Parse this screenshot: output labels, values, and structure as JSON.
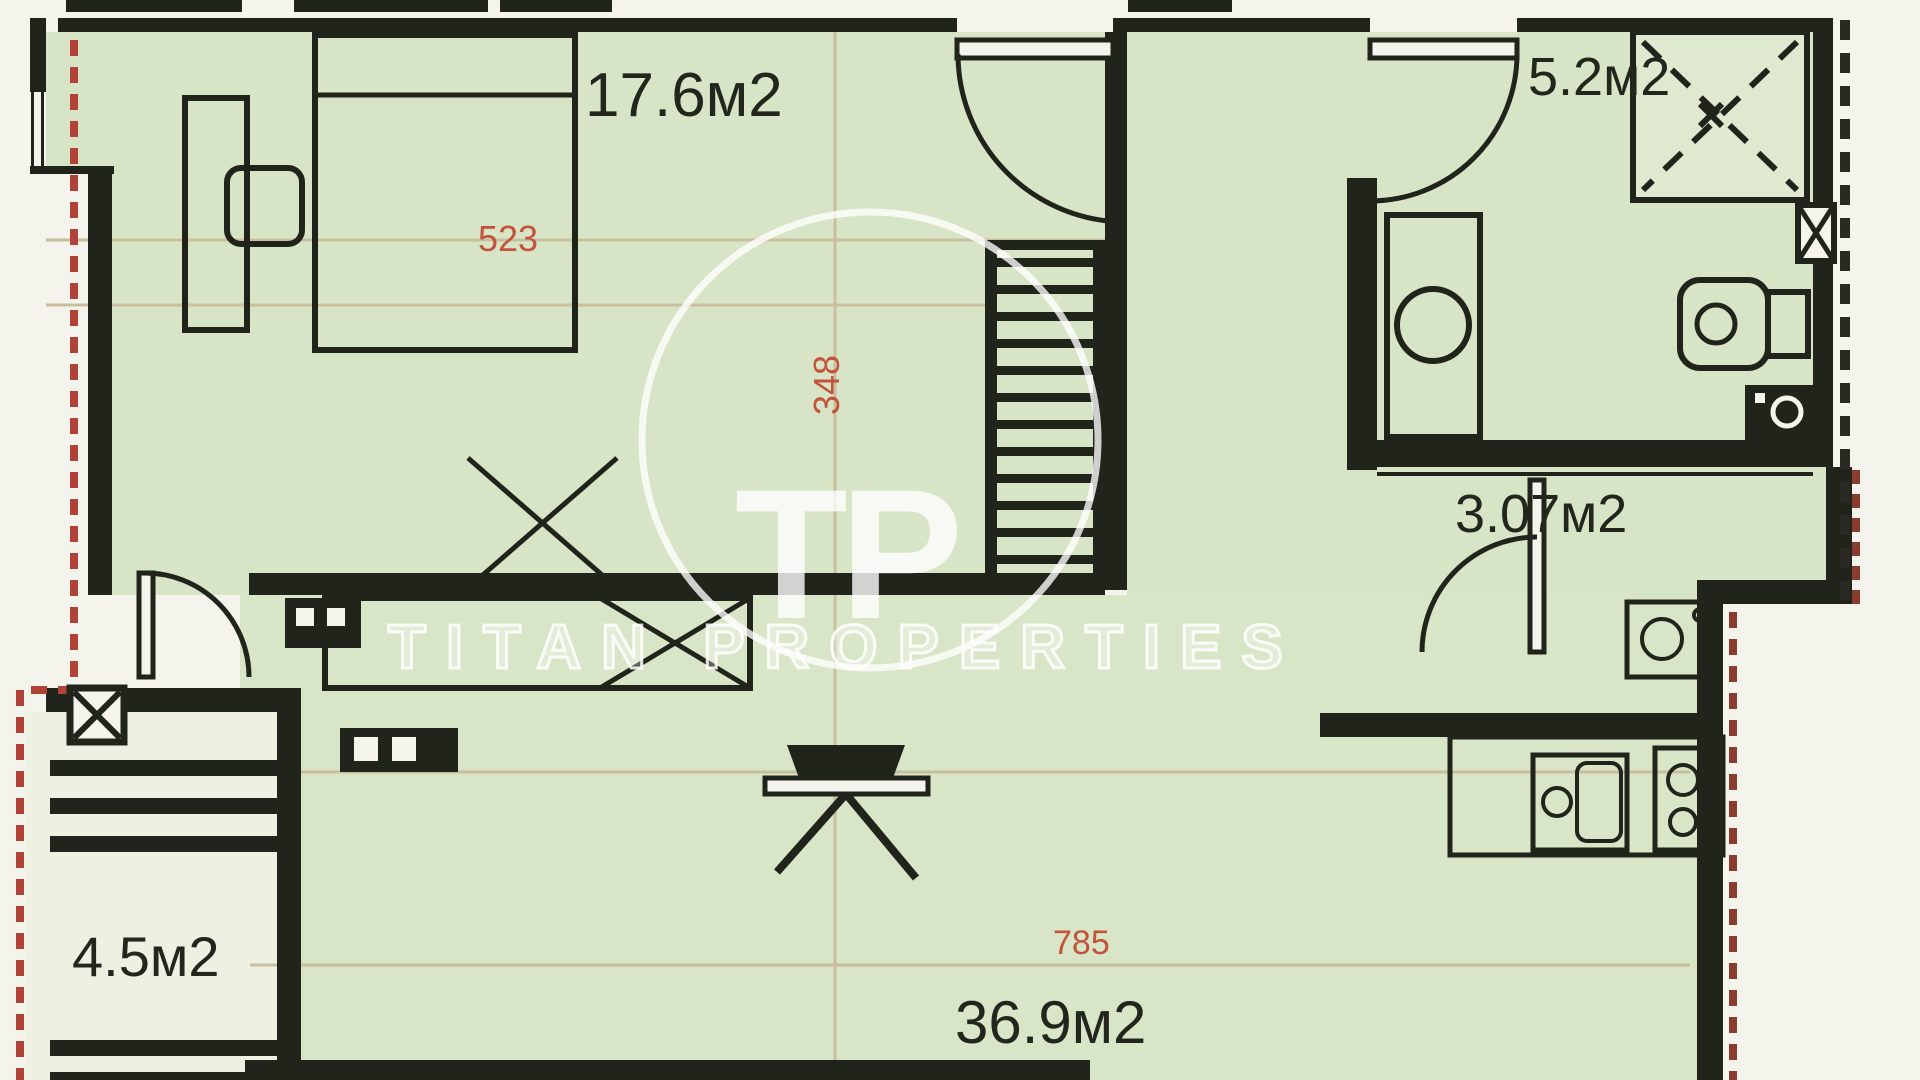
{
  "watermark": {
    "brand": "TITAN PROPERTIES",
    "monogram": "TP"
  },
  "rooms": {
    "bedroom": {
      "area": "17.6м2"
    },
    "shower_room": {
      "area": "5.2м2"
    },
    "corridor": {
      "area": "3.07м2"
    },
    "terrace": {
      "area": "4.5м2"
    },
    "living_kitchen": {
      "area": "36.9м2"
    }
  },
  "dimensions": {
    "bedroom_width": "523",
    "bedroom_depth": "348",
    "living_width": "785"
  },
  "colors": {
    "room_fill": "#d8e4c6",
    "terrace_fill": "#eef0e2",
    "wall": "#20241a",
    "dimension_text": "#c2543c",
    "boundary_dash": "#b04238",
    "guide_line": "#c9bf9e",
    "watermark": "#ffffff"
  }
}
